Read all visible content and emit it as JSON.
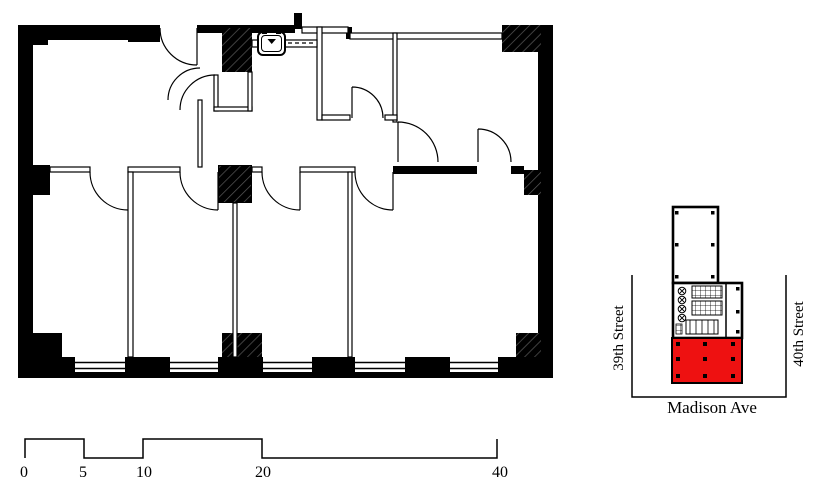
{
  "drawing": {
    "type_label": "floor-plan-with-key-map"
  },
  "key_map": {
    "street_left": "39th Street",
    "street_right": "40th Street",
    "avenue": "Madison Ave",
    "highlight_color": "#ee1111"
  },
  "scale_bar": {
    "labels": [
      {
        "text": "0"
      },
      {
        "text": "5"
      },
      {
        "text": "10"
      },
      {
        "text": "20"
      },
      {
        "text": "40"
      }
    ]
  }
}
